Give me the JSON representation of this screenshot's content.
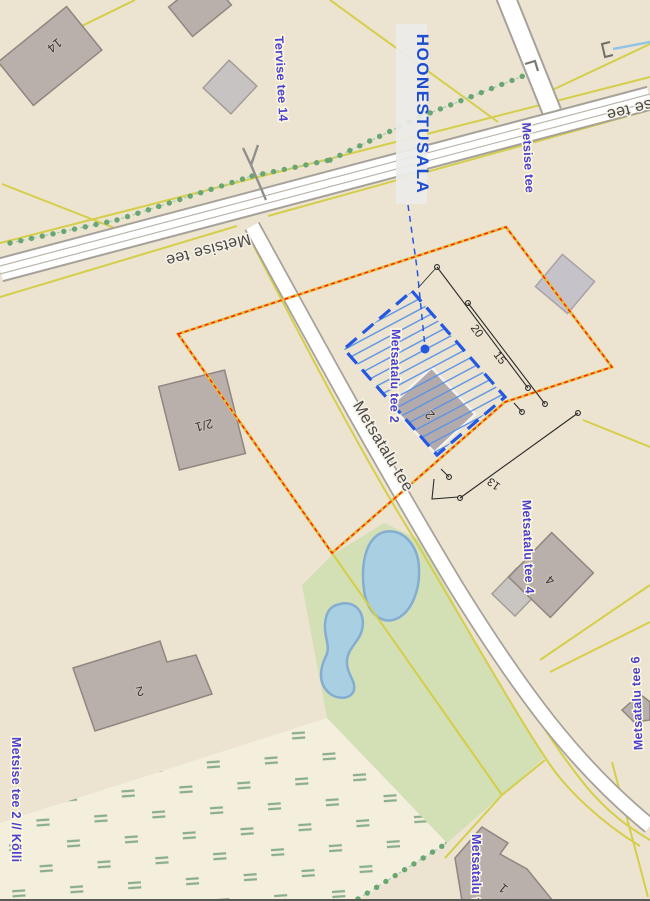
{
  "annotation": {
    "hoonestusala": "HOONESTUSALA"
  },
  "roads": {
    "metsise_tee": "Metsise tee",
    "metsatalu_tee": "Metsatalu tee"
  },
  "addresses": {
    "tervise_tee_14": "Tervise tee 14",
    "metsise_tee": "Metsise tee",
    "metsatalu_tee_2": "Metsatalu tee 2",
    "metsatalu_tee_4": "Metsatalu tee 4",
    "metsatalu_tee_6": "Metsatalu tee 6",
    "metsise_tee_2_kolli": "Metsise tee 2 // Kõlli",
    "metsa_partial": "Metsatalu tee"
  },
  "buildings": {
    "n14": "14",
    "n2_1": "2/1",
    "n2_envelope": "2",
    "n2_sw": "2",
    "n4": "4",
    "n1": "1"
  },
  "dimensions": {
    "len20": "20",
    "len15": "15",
    "len13": "13"
  },
  "colors": {
    "base": "#ece4d0",
    "road_fill": "#ffffff",
    "road_casing": "#a6a29a",
    "cadastral_line": "#d4ce4a",
    "boundary_yellow": "#e3bd3e",
    "boundary_red": "#ff2400",
    "envelope_blue": "#2458e0",
    "hatch_blue": "#5b93e8",
    "address_blue": "#4a3fd1",
    "annotation_blue": "#1d4ecf",
    "green_area": "#d3dfb5",
    "meadow": "#f3efdc",
    "pond_fill": "#a9cfe3",
    "pond_stroke": "#84add1",
    "building_fill": "#b9b0ab",
    "tree_green": "#69a671"
  }
}
